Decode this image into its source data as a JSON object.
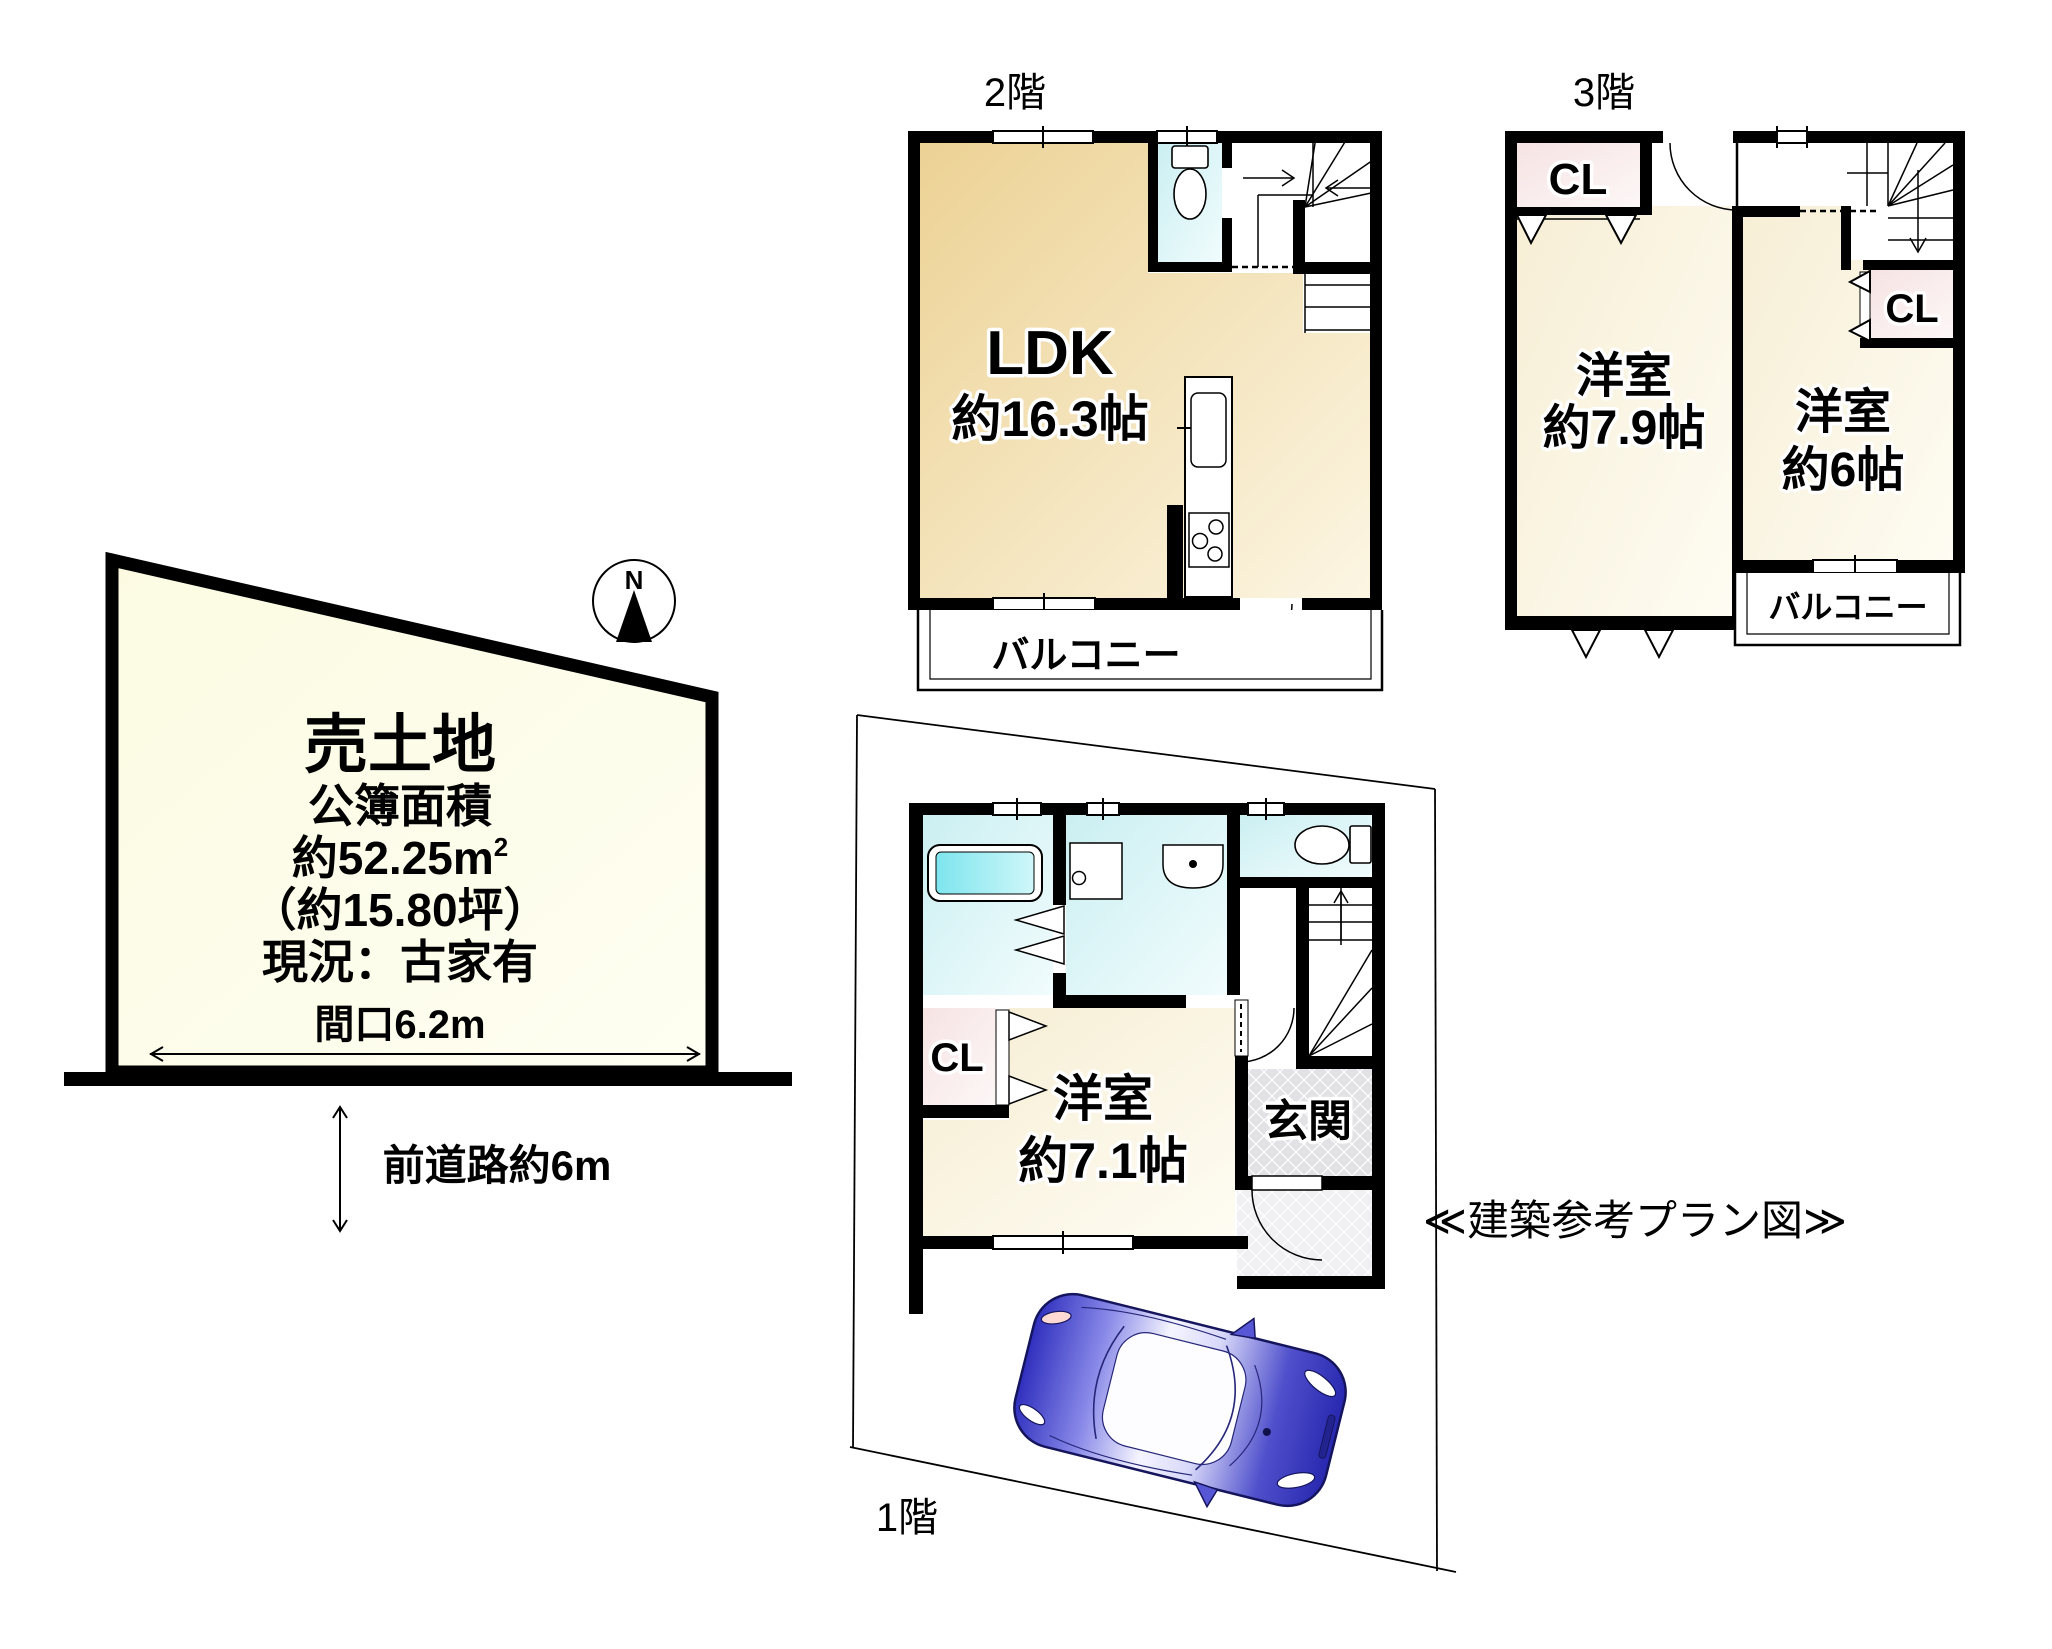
{
  "meta": {
    "caption": "≪建築参考プラン図≫"
  },
  "colors": {
    "land_fill": "#FDFDE9",
    "room_warm": "#ECD193",
    "room_cream": "#F6EDD2",
    "wet_area_cyan": "#CBEFF2",
    "closet_pink": "#F6E3E3",
    "entrance_tile": "#E2E2E6",
    "car_blue": "#3A3AC8",
    "line_black": "#000000"
  },
  "land": {
    "title": "売土地",
    "area_caption": "公簿面積",
    "area_value": "約52.25m",
    "area_sup": "2",
    "area_tsubo": "（約15.80坪）",
    "status": "現況：古家有",
    "frontage": "間口6.2m",
    "front_road": "前道路約6m",
    "compass": "N"
  },
  "floor2": {
    "title": "2階",
    "ldk": "LDK",
    "ldk_size": "約16.3帖",
    "balcony": "バルコニー"
  },
  "floor3": {
    "title": "3階",
    "room_a": "洋室",
    "room_a_size": "約7.9帖",
    "room_b": "洋室",
    "room_b_size": "約6帖",
    "closet_a": "CL",
    "closet_b": "CL",
    "balcony": "バルコニー"
  },
  "floor1": {
    "title": "1階",
    "room": "洋室",
    "room_size": "約7.1帖",
    "closet": "CL",
    "entrance": "玄関"
  }
}
